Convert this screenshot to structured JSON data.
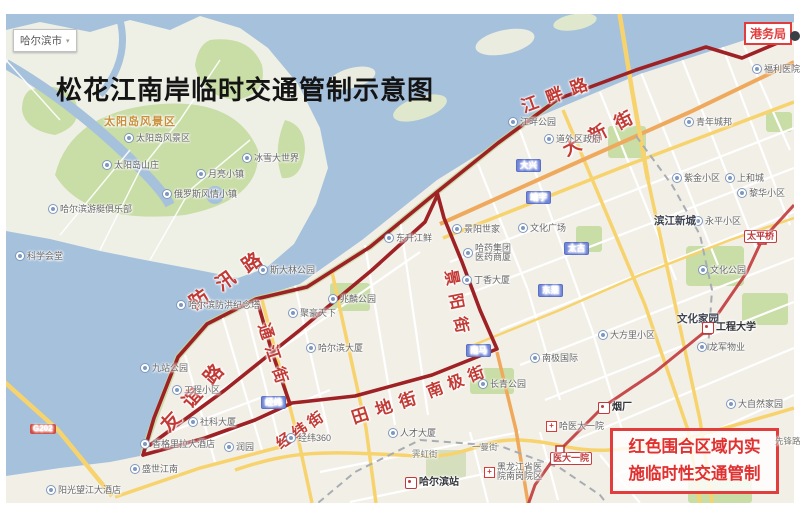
{
  "title": "松花江南岸临时交通管制示意图",
  "city_selector": {
    "label": "哈尔滨市"
  },
  "port_box": {
    "label": "港务局"
  },
  "notice_box": {
    "line1": "红色围合区域内实",
    "line2": "施临时性交通管制"
  },
  "colors": {
    "water": "#a6c1dc",
    "land": "#f2efe7",
    "park": "#c9dda6",
    "road_yellow": "#f7d36e",
    "road_orange": "#efa95c",
    "boundary_red": "#9e2125",
    "label_red": "#c23a35",
    "metro_red": "#c0393b"
  },
  "area_labels": [
    {
      "text": "太阳岛风景区",
      "x": 104,
      "y": 117
    }
  ],
  "street_labels_red": [
    {
      "text": "江畔路",
      "x": 522,
      "y": 99,
      "rot": -20,
      "size": 17,
      "ls": 9
    },
    {
      "text": "大新街",
      "x": 564,
      "y": 142,
      "rot": -27,
      "size": 18,
      "ls": 11
    },
    {
      "text": "防汛路",
      "x": 192,
      "y": 296,
      "rot": -35,
      "size": 19,
      "ls": 13
    },
    {
      "text": "友谊路",
      "x": 165,
      "y": 420,
      "rot": -48,
      "size": 19,
      "ls": 13
    },
    {
      "text": "通江街",
      "x": 262,
      "y": 316,
      "rot": 72,
      "size": 16,
      "ls": 7
    },
    {
      "text": "景阳街",
      "x": 449,
      "y": 262,
      "rot": 79,
      "size": 16,
      "ls": 8
    },
    {
      "text": "南极街",
      "x": 428,
      "y": 386,
      "rot": -21,
      "size": 16,
      "ls": 6
    },
    {
      "text": "田地街",
      "x": 352,
      "y": 410,
      "rot": -18,
      "size": 17,
      "ls": 8
    },
    {
      "text": "经纬街",
      "x": 278,
      "y": 438,
      "rot": -34,
      "size": 15,
      "ls": 4
    }
  ],
  "road_badges": [
    {
      "text": "大兴",
      "x": 516,
      "y": 159
    },
    {
      "text": "靖宇",
      "x": 526,
      "y": 191
    },
    {
      "text": "太古",
      "x": 564,
      "y": 242
    },
    {
      "text": "东莱",
      "x": 538,
      "y": 284
    },
    {
      "text": "南马",
      "x": 466,
      "y": 344
    },
    {
      "text": "经纬",
      "x": 261,
      "y": 396
    }
  ],
  "g_badges": [
    {
      "text": "G202",
      "x": 30,
      "y": 424
    }
  ],
  "poi_labels": [
    {
      "text": "太阳岛风景区",
      "x": 124,
      "y": 133
    },
    {
      "text": "太阳岛山庄",
      "x": 102,
      "y": 160
    },
    {
      "text": "月亮小镇",
      "x": 196,
      "y": 169
    },
    {
      "text": "冰雪大世界",
      "x": 242,
      "y": 153
    },
    {
      "text": "俄罗斯风情小镇",
      "x": 162,
      "y": 189
    },
    {
      "text": "哈尔滨游艇俱乐部",
      "x": 48,
      "y": 204
    },
    {
      "text": "科学会堂",
      "x": 15,
      "y": 251
    },
    {
      "text": "斯大林公园",
      "x": 258,
      "y": 265
    },
    {
      "text": "哈尔滨防洪纪念塔",
      "x": 176,
      "y": 300
    },
    {
      "text": "九站公园",
      "x": 140,
      "y": 363
    },
    {
      "text": "兆麟公园",
      "x": 328,
      "y": 294
    },
    {
      "text": "聚豪天下",
      "x": 288,
      "y": 308
    },
    {
      "text": "哈尔滨大厦",
      "x": 306,
      "y": 343
    },
    {
      "text": "工程小区",
      "x": 172,
      "y": 385
    },
    {
      "text": "社科大厦",
      "x": 188,
      "y": 417
    },
    {
      "text": "香格里拉大酒店",
      "x": 140,
      "y": 439
    },
    {
      "text": "润园",
      "x": 224,
      "y": 442
    },
    {
      "text": "盛世江南",
      "x": 130,
      "y": 464
    },
    {
      "text": "阳光望江大酒店",
      "x": 46,
      "y": 485
    },
    {
      "text": "经纬360",
      "x": 286,
      "y": 433
    },
    {
      "text": "人才大厦",
      "x": 388,
      "y": 428
    },
    {
      "text": "江畔公园",
      "x": 508,
      "y": 117
    },
    {
      "text": "道外区政府",
      "x": 544,
      "y": 134
    },
    {
      "text": "福利医院",
      "x": 752,
      "y": 64
    },
    {
      "text": "青年城邦",
      "x": 684,
      "y": 117
    },
    {
      "text": "东升江鲜",
      "x": 384,
      "y": 233
    },
    {
      "text": "景阳世家",
      "x": 452,
      "y": 224
    },
    {
      "text": "哈药集团",
      "text2": "医药商厦",
      "x": 463,
      "y": 244
    },
    {
      "text": "文化广场",
      "x": 518,
      "y": 223
    },
    {
      "text": "丁香大厦",
      "x": 462,
      "y": 275
    },
    {
      "text": "南极国际",
      "x": 530,
      "y": 353
    },
    {
      "text": "长青公园",
      "x": 478,
      "y": 379
    },
    {
      "text": "大方里小区",
      "x": 598,
      "y": 330
    },
    {
      "text": "紫金小区",
      "x": 672,
      "y": 173
    },
    {
      "text": "上和城",
      "x": 725,
      "y": 173
    },
    {
      "text": "黎华小区",
      "x": 737,
      "y": 188
    },
    {
      "text": "永平小区",
      "x": 693,
      "y": 216
    },
    {
      "text": "文化公园",
      "x": 698,
      "y": 265
    },
    {
      "text": "龙军物业",
      "x": 697,
      "y": 342
    },
    {
      "text": "大自然家园",
      "x": 726,
      "y": 399
    },
    {
      "text": "黑龙江省医",
      "text2": "院南岗院区",
      "x": 484,
      "y": 463,
      "icon": "cross"
    },
    {
      "text": "哈医大一院",
      "x": 546,
      "y": 421,
      "icon": "cross"
    }
  ],
  "bold_labels": [
    {
      "text": "滨江新城",
      "x": 654,
      "y": 216
    },
    {
      "text": "文化家园",
      "x": 677,
      "y": 314
    }
  ],
  "metro_stations": [
    {
      "text": "工程大学",
      "x": 702,
      "y": 322,
      "style": "logo"
    },
    {
      "text": "烟厂",
      "x": 598,
      "y": 402,
      "style": "logo"
    },
    {
      "text": "哈尔滨站",
      "x": 405,
      "y": 477,
      "style": "logo"
    },
    {
      "text": "太平桥",
      "x": 744,
      "y": 230,
      "style": "box"
    },
    {
      "text": "医大一院",
      "x": 550,
      "y": 452,
      "style": "box"
    }
  ],
  "street_labels_small": [
    {
      "text": "霁虹街",
      "x": 412,
      "y": 450
    },
    {
      "text": "一曼街",
      "x": 472,
      "y": 443
    },
    {
      "text": "先锋路",
      "x": 775,
      "y": 437
    }
  ]
}
